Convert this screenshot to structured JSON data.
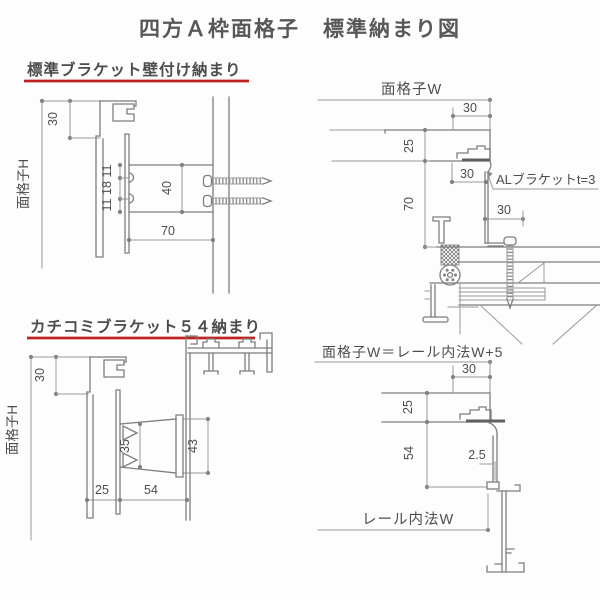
{
  "title": "四方Ａ枠面格子　標準納まり図",
  "colors": {
    "accent_red": "#bf2321",
    "line_gray": "#8a8a8a",
    "text_gray": "#4f4f4f"
  },
  "sections": {
    "std_bracket": {
      "heading": "標準ブラケット壁付け納まり",
      "labels": {
        "height": "面格子H",
        "top_offset": "30",
        "hole_top": "11",
        "hole_mid": "18",
        "hole_bottom": "11",
        "bracket_height": "40",
        "bracket_depth": "70"
      }
    },
    "kachikomi": {
      "heading": "カチコミブラケット５４納まり",
      "labels": {
        "height": "面格子H",
        "top_offset": "30",
        "wedge": "35",
        "bracket_height": "43",
        "frame_depth": "25",
        "bracket_depth": "54"
      }
    },
    "plan_top": {
      "width_label": "面格子W",
      "bracket_note": "ALブラケットt=3",
      "labels": {
        "edge_offset": "30",
        "frame_depth": "25",
        "bracket_offset": "30",
        "anchor_offset": "30",
        "wall_depth": "70"
      }
    },
    "plan_bottom": {
      "width_label": "面格子W＝レール内法W+5",
      "rail_label": "レール内法W",
      "labels": {
        "edge_offset": "30",
        "frame_depth": "25",
        "drop": "54",
        "plate_thickness": "2.5"
      }
    }
  }
}
